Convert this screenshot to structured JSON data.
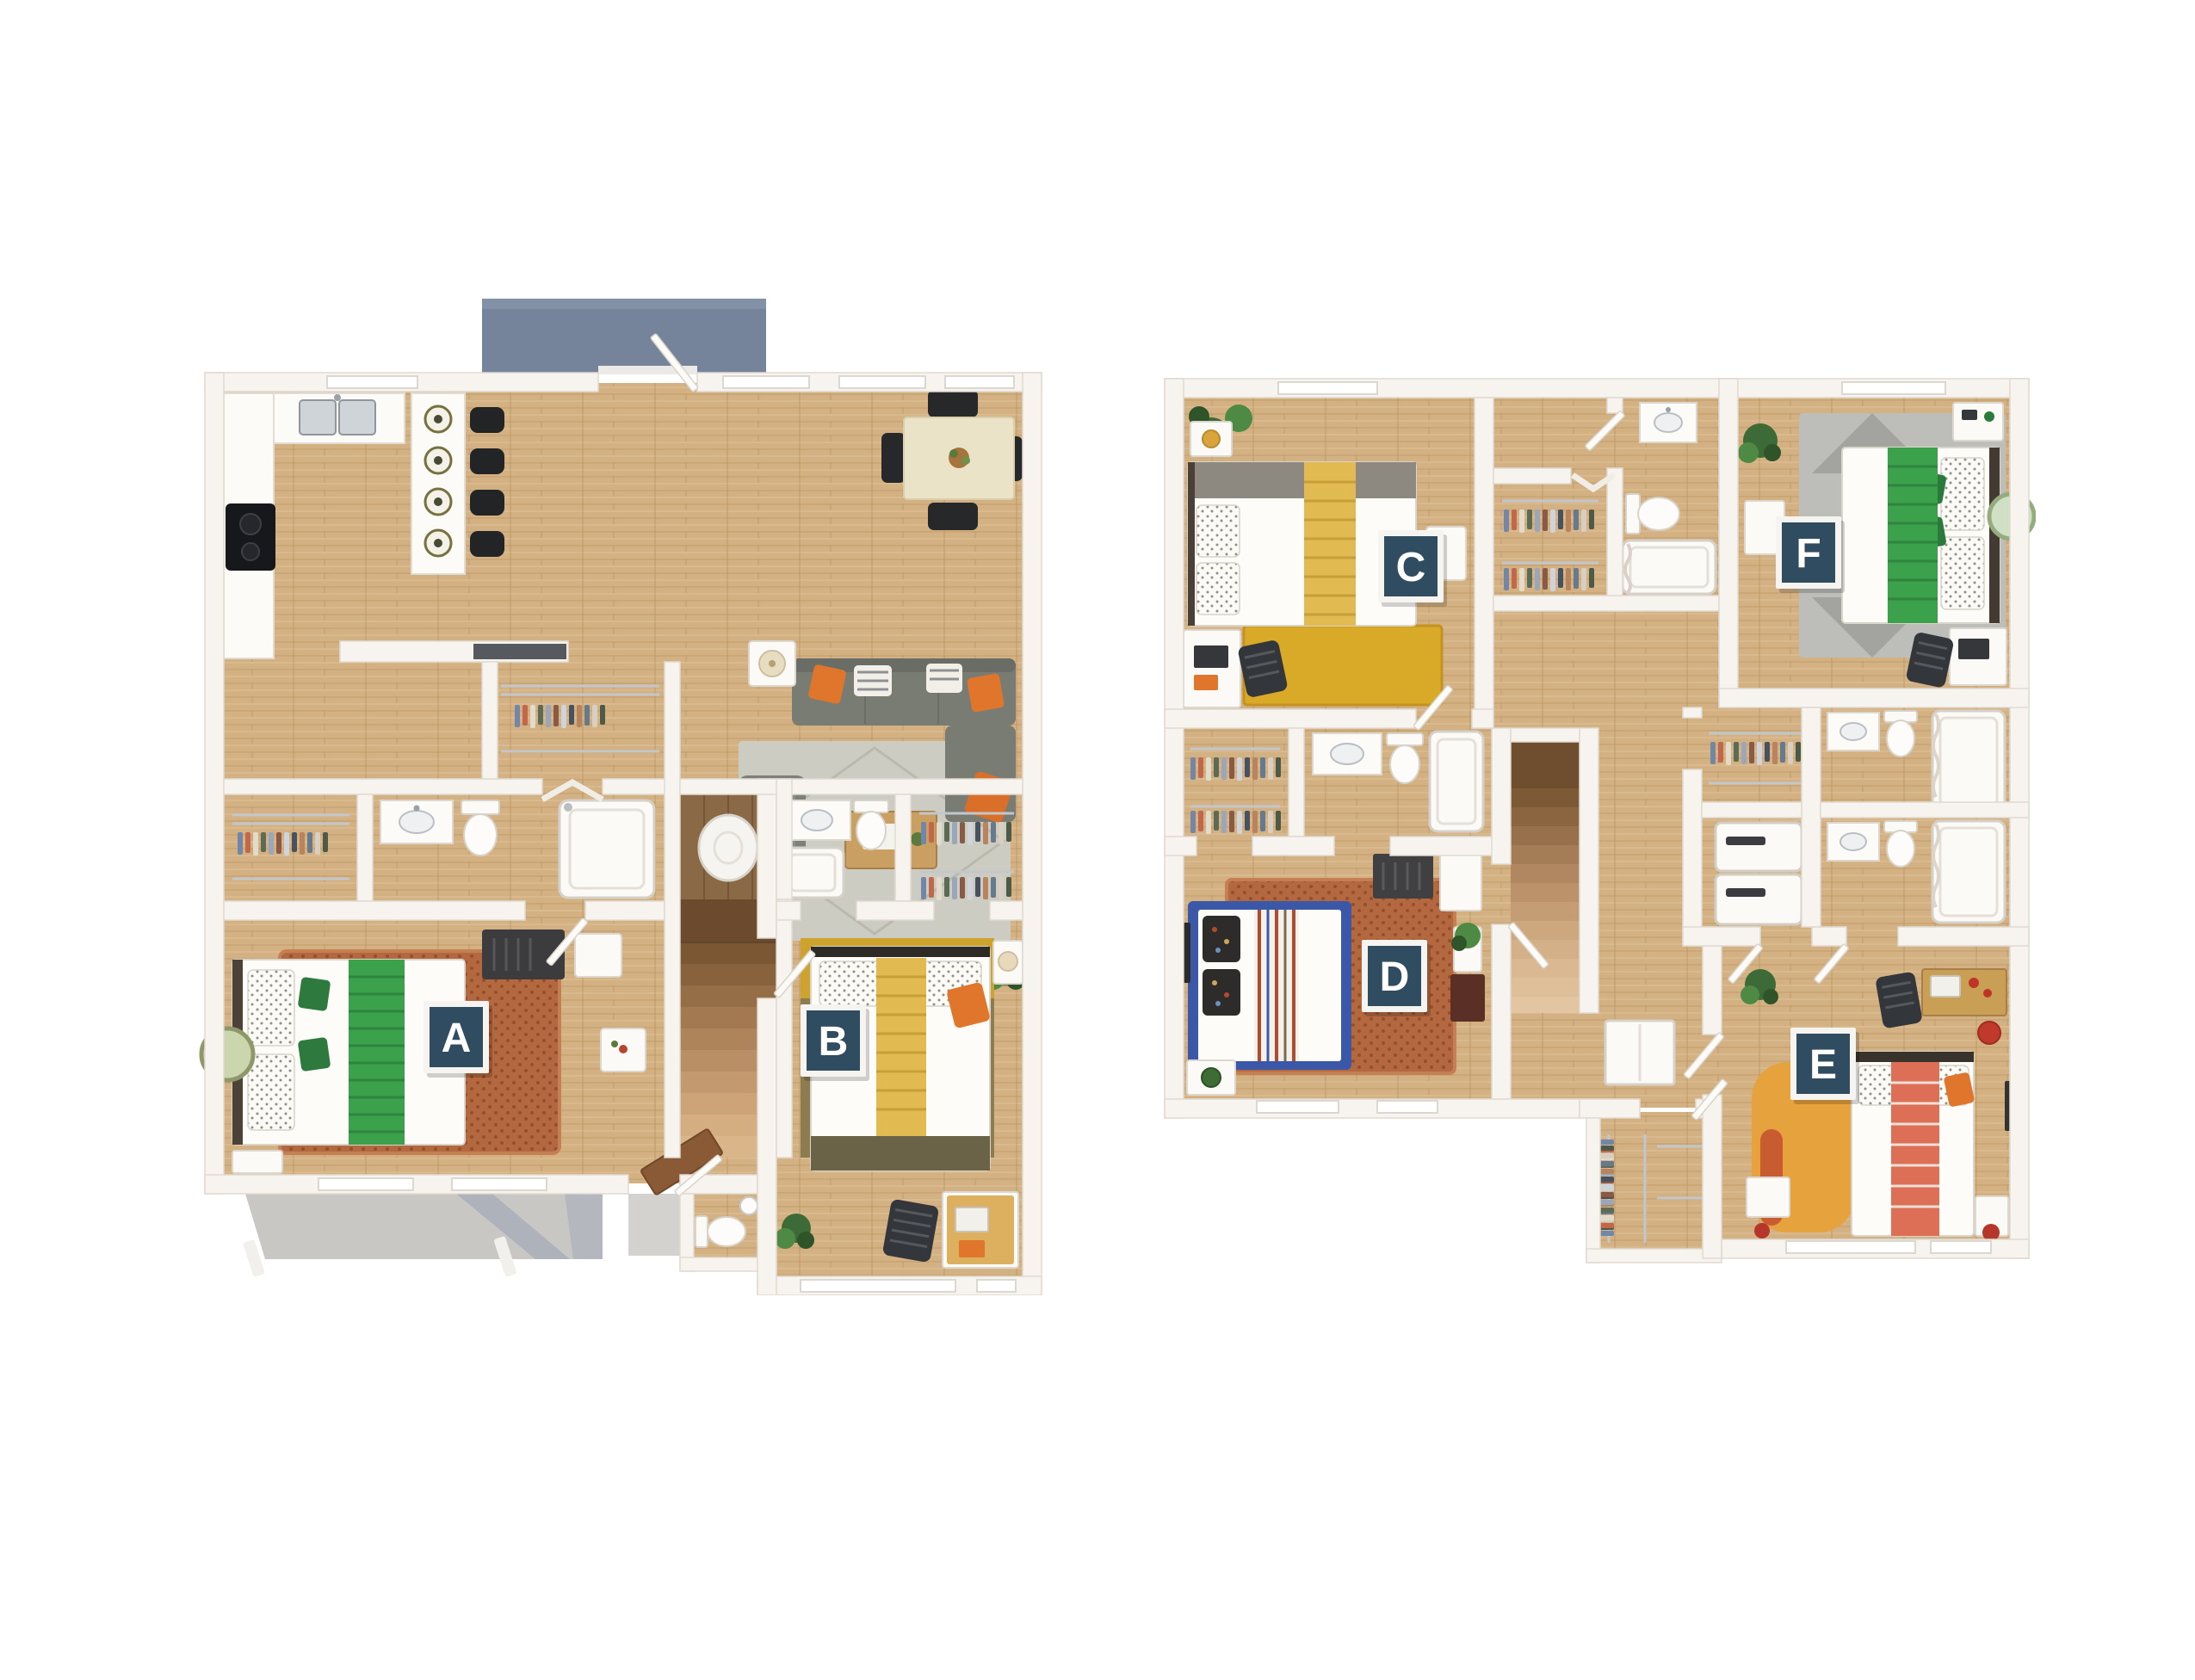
{
  "page": {
    "background": "#ffffff",
    "description": "two-level 3d floor plan rendering"
  },
  "floor_plans": [
    {
      "id": "first-floor",
      "position": "left",
      "badges": [
        {
          "letter": "A"
        },
        {
          "letter": "B"
        }
      ],
      "rooms": [
        "balcony",
        "kitchen",
        "dining-area",
        "living-room",
        "hall-closet",
        "water-heater-closet",
        "stairs",
        "walk-in-closet-a",
        "bathroom-a",
        "bedroom-a",
        "bathroom-b",
        "walk-in-closet-b",
        "bedroom-b",
        "half-bathroom",
        "entry",
        "patio"
      ]
    },
    {
      "id": "second-floor",
      "position": "right",
      "badges": [
        {
          "letter": "C"
        },
        {
          "letter": "D"
        },
        {
          "letter": "E"
        },
        {
          "letter": "F"
        }
      ],
      "rooms": [
        "bedroom-c",
        "walk-in-closet-d",
        "bathroom-d",
        "bedroom-d",
        "hall-closet",
        "bathroom-c",
        "bedroom-f",
        "walk-in-closet-f",
        "laundry-closet",
        "bathroom-f",
        "bathroom-e",
        "hallway",
        "stairs",
        "linen-cabinet",
        "bedroom-e",
        "walk-in-closet-e"
      ]
    }
  ],
  "badge_style": {
    "background": "#2f4c60",
    "border": "#f6f4f0",
    "text_color": "#ffffff"
  },
  "colors": {
    "wall": "#f7f4ef",
    "wall_edge": "#e0dad1",
    "wood_floor": "#d3b183",
    "wood_floor_dark": "#8a6946",
    "balcony": "#76849b",
    "patio_concrete": "#c9c7c4",
    "patio_shadow": "#95a0b4",
    "sofa_gray": "#797c73",
    "living_rug": "#ccccc2",
    "accent_orange": "#df762c",
    "bed_green": "#3ba14b",
    "bed_yellow": "#e2ba52",
    "bed_coral": "#dc6f55",
    "bed_blue_frame": "#3a57a8",
    "rug_rust": "#b4683f",
    "rug_mustard": "#cda32e",
    "rug_yellow": "#d9a928",
    "rug_gray": "#bdbdb9",
    "rug_orange": "#e6a23c",
    "stair_dark": "#6b4a2d",
    "stair_light": "#d2ab75",
    "plant_green": "#4f8a45",
    "appliance_black": "#17181b",
    "steel": "#cfd4d8"
  }
}
